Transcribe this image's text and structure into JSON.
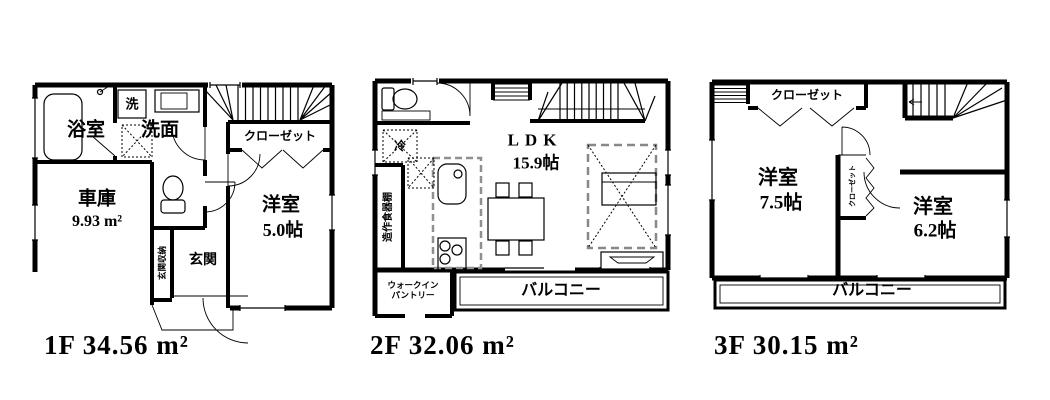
{
  "floors": [
    {
      "id": "1f",
      "area_label": "1F 34.56 m²",
      "rooms": {
        "bath": "浴室",
        "washer": "洗",
        "washroom": "洗面",
        "closet": "クローゼット",
        "garage_name": "車庫",
        "garage_area": "9.93 m²",
        "entrance_storage": "玄関収納",
        "entrance": "玄関",
        "western_room": "洋室",
        "western_room_size": "5.0帖"
      }
    },
    {
      "id": "2f",
      "area_label": "2F 32.06 m²",
      "rooms": {
        "fridge": "冷",
        "cupboard": "造作食器棚",
        "ldk": "LDK",
        "ldk_size": "15.9帖",
        "pantry_line1": "ウォークイン",
        "pantry_line2": "パントリー",
        "balcony": "バルコニー"
      }
    },
    {
      "id": "3f",
      "area_label": "3F 30.15 m²",
      "rooms": {
        "closet_top": "クローゼット",
        "western_room_1": "洋室",
        "western_room_1_size": "7.5帖",
        "closet_mid": "クローゼット",
        "western_room_2": "洋室",
        "western_room_2_size": "6.2帖",
        "balcony": "バルコニー"
      }
    }
  ]
}
